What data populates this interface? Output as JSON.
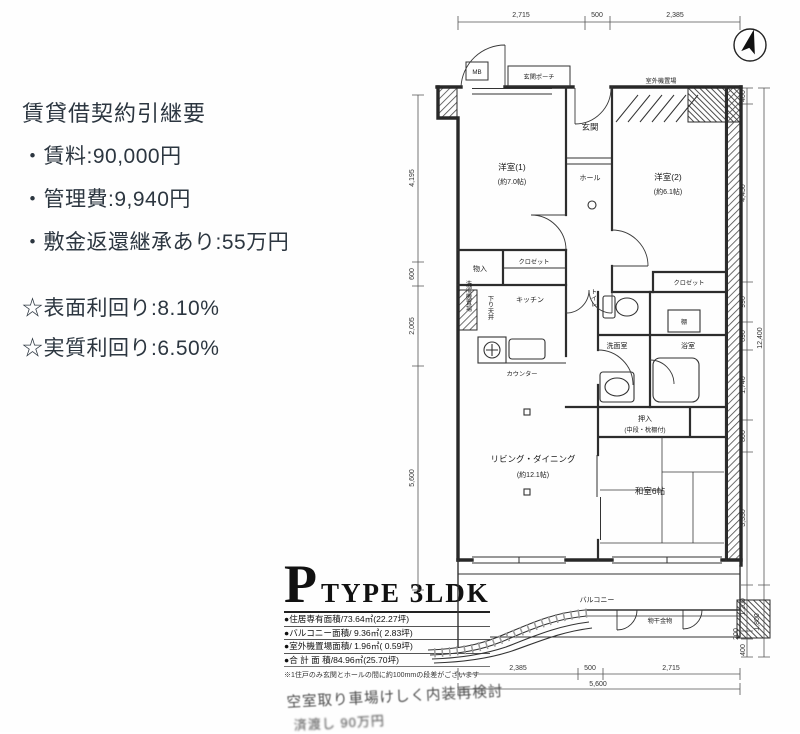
{
  "contract": {
    "title": "賃貸借契約引継要",
    "items": [
      "・賃料:90,000円",
      "・管理費:9,940円",
      "・敷金返還継承あり:55万円"
    ],
    "yields": [
      "☆表面利回り:8.10%",
      "☆実質利回り:6.50%"
    ]
  },
  "type_block": {
    "letter": "P",
    "name": "TYPE 3LDK",
    "areas": [
      "●住居専有面積/73.64㎡(22.27坪)",
      "●バルコニー面積/ 9.36㎡( 2.83坪)",
      "●室外機置場面積/ 1.96㎡( 0.59坪)",
      "●合 計 面 積/84.96㎡(25.70坪)"
    ],
    "note": "※1住戸のみ玄関とホールの間に約100mmの段差がございます",
    "handwritten": [
      "空室取り車場けしく内装再検討",
      "済渡し 90万円"
    ]
  },
  "plan": {
    "labels": {
      "mb": "MB",
      "porch": "玄関ポーチ",
      "outdoor_unit": "室外機置場",
      "entrance": "玄関",
      "hall": "ホール",
      "western1": "洋室(1)",
      "western1_size": "(約7.0帖)",
      "western2": "洋室(2)",
      "western2_size": "(約6.1帖)",
      "storage1": "物入",
      "closet1": "クロゼット",
      "closet2": "クロゼット",
      "kitchen": "キッチン",
      "counter": "カウンター",
      "lowered_ceiling": "下り天井",
      "washer": "洗濯機置場",
      "toilet": "トイレ",
      "washroom": "洗面室",
      "bathroom": "浴室",
      "shelf": "棚",
      "oshiire": "押入",
      "oshiire_sub": "(中段・枕棚付)",
      "living": "リビング・ダイニング",
      "living_size": "(約12.1帖)",
      "japanese_room": "和室6帖",
      "balcony": "バルコニー",
      "laundry_bracket": "物干金物"
    },
    "dims": {
      "top": [
        "2,715",
        "500",
        "2,385"
      ],
      "left": [
        "4,195",
        "600",
        "2,005",
        "5,600"
      ],
      "right": [
        "400",
        "4,450",
        "990",
        "690",
        "1,740",
        "800",
        "3,330"
      ],
      "right_total": "12,400",
      "balcony_right": [
        "1,200",
        "200",
        "400"
      ],
      "balcony_total": "1,800",
      "bottom": [
        "2,385",
        "500",
        "2,715"
      ],
      "bottom_total": "5,600"
    }
  }
}
